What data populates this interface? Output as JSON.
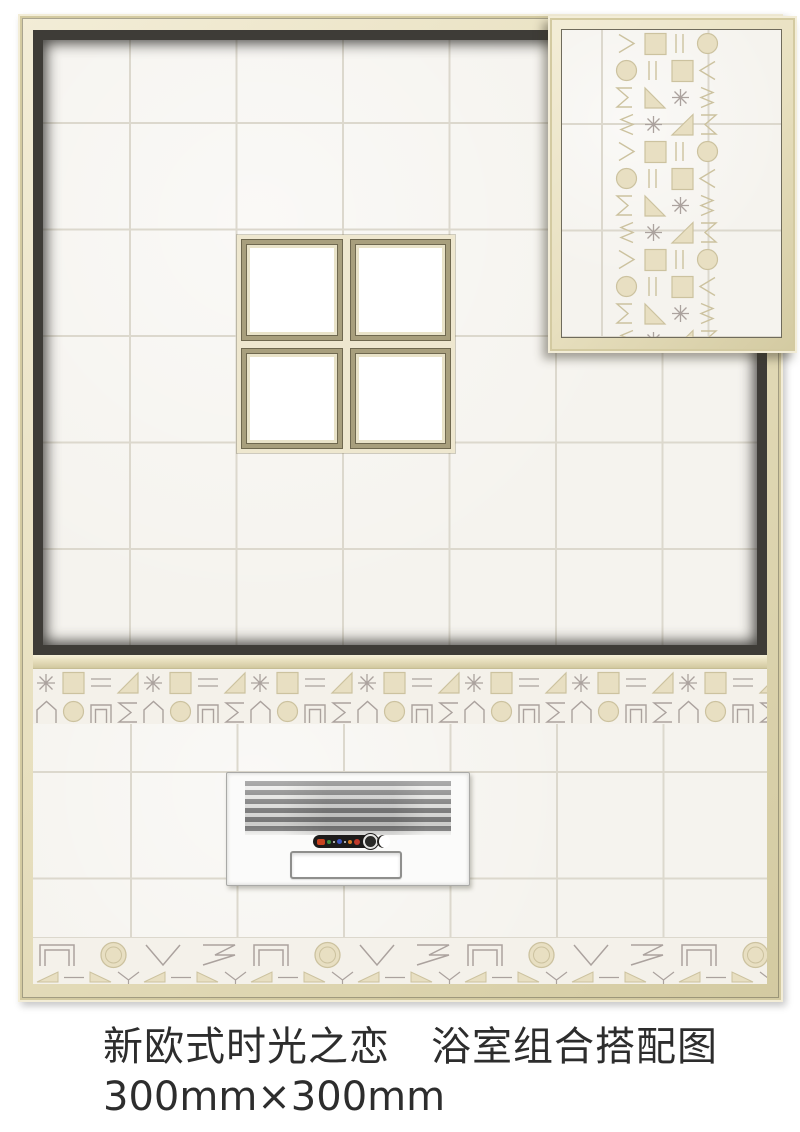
{
  "caption": {
    "line1": "新欧式时光之恋　浴室组合搭配图",
    "line2": "300mm×300mm"
  },
  "colors": {
    "frame-beige": "#e7dfbe",
    "frame-beige-light": "#f3edd7",
    "frame-beige-dark": "#d3caa1",
    "frame-line": "#6f6b5c",
    "wall-dark": "#3e3c37",
    "tile": "#f5f3ee",
    "tile-grout": "#dcd8cd",
    "window-olive": "#a89f7d",
    "window-olive-dark": "#6f684f",
    "window-cream": "#eee7cf",
    "pattern-beige": "#ccc29f",
    "pattern-fill": "#e8dfc2",
    "pattern-gray": "#aba29e",
    "grille-gray": "#8d8d8d",
    "heater-body": "#fbfbfa",
    "pill-dark": "#1d1b1a",
    "pill-red": "#c9431f",
    "pill-green": "#3f8f3f",
    "pill-blue": "#3c55c0",
    "pill-orange": "#d97b22",
    "text": "#2d2d2d"
  }
}
